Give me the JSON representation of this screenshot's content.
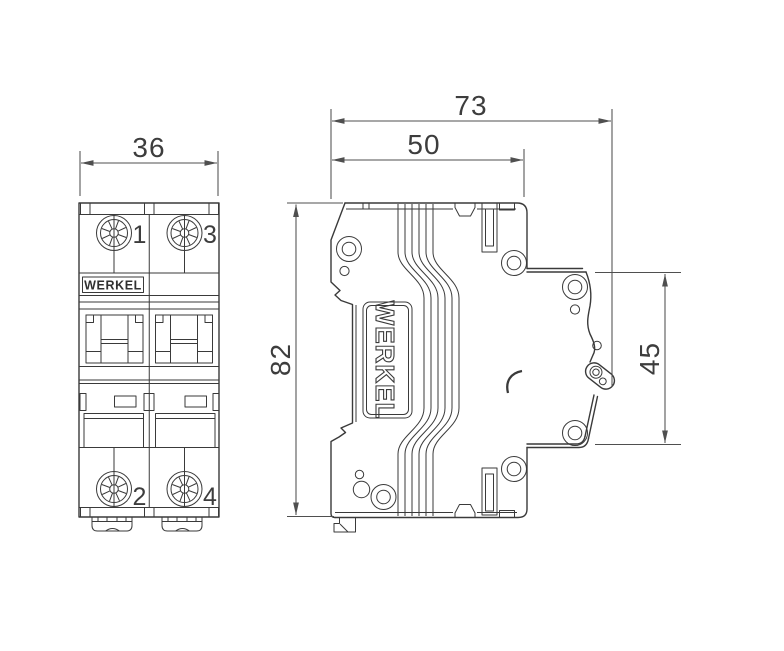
{
  "drawing": {
    "kind": "dimensional technical drawing",
    "views": [
      "front view",
      "side view"
    ]
  },
  "front_view": {
    "brand_label": "WERKEL",
    "width_dim": "36",
    "terminals": {
      "top_left": "1",
      "top_right": "3",
      "bottom_left": "2",
      "bottom_right": "4"
    }
  },
  "side_view": {
    "brand_label": "WERKEL",
    "depth_total_dim": "73",
    "depth_body_dim": "50",
    "height_dim": "82",
    "rear_height_dim": "45"
  },
  "colors": {
    "line": "#3a3a3a",
    "dimension": "#4f4f4f",
    "text": "#3d3d3d",
    "background": "#ffffff"
  }
}
